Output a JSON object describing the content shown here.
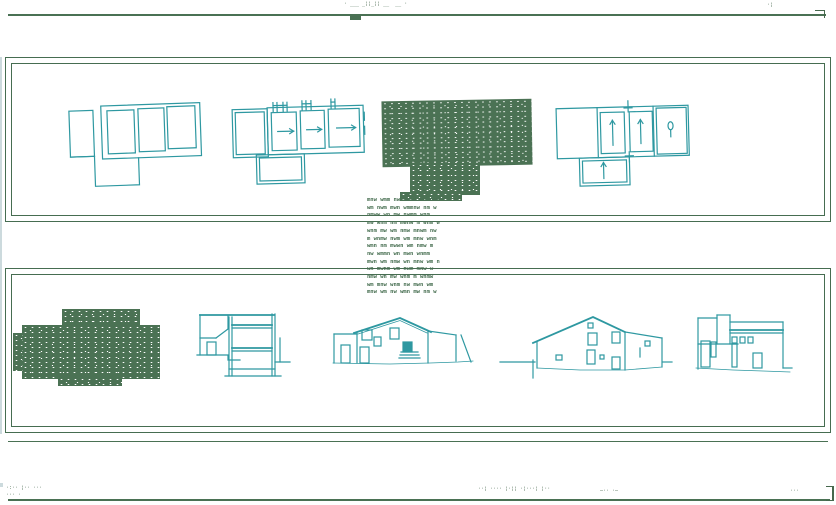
{
  "colors": {
    "ink_green": "#4a7154",
    "line_teal": "#2e98a1",
    "paper": "#ffffff",
    "edge_strip": "#ccdadd"
  },
  "top": {
    "title_marks": "· ___ _¦¦_¦¦ __  __ ·",
    "right_tick": "·¦"
  },
  "notes": {
    "lines": [
      "mnw wmm nw mwnm wm nmw",
      "wm nwm mwn wmmnw nm w",
      "nmww wn mw nwmm wnm",
      "mw wnm nm mwnw m wnm w",
      "wnm mw wm nmw mnwm nw",
      "m wnmw nwm wm mnw wnm",
      "wmn nm mwwn wm nmw m",
      "nw wmmn wn mwn wnmm",
      "mwn wm nmw wn mnw wm n",
      "wn mwnm wm nwm mnw w",
      "nmw wn mw wnm m wnmw",
      "wm mnw wnm nw mwn wm",
      "mnw wm nw wmn mw nm w"
    ]
  },
  "bottom": {
    "left_marks_1": "·:·· ¦·· ···",
    "left_marks_2": "··· ·",
    "center_marks": "··¦ ···· ¦·¦¦ ·¦···¦ ¦··",
    "mid_marks": "—·· ·—",
    "right_marks": "···"
  }
}
